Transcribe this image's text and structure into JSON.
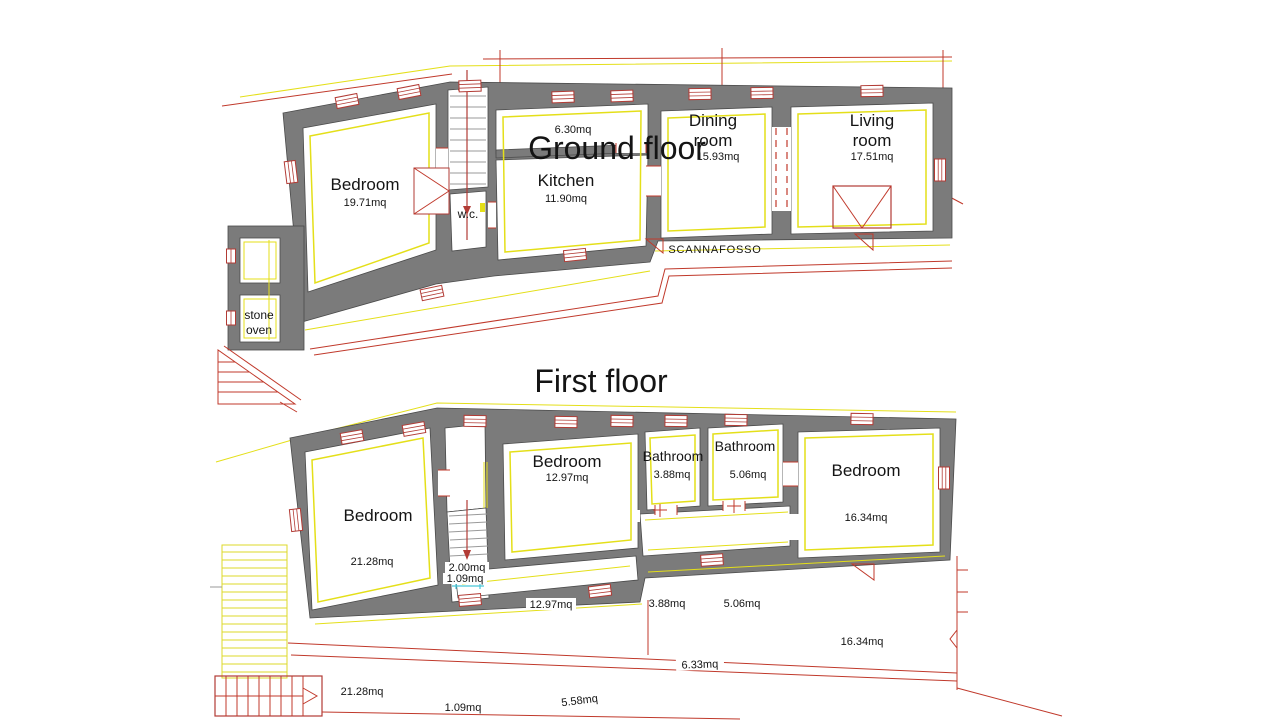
{
  "page": {
    "background": "#ffffff"
  },
  "titles": {
    "ground_floor": "Ground floor",
    "first_floor": "First floor"
  },
  "ground_floor": {
    "rooms": [
      {
        "name": "Bedroom",
        "area": "19.71mq"
      },
      {
        "name": "Kitchen",
        "area": "11.90mq"
      },
      {
        "name_line1": "Dining",
        "name_line2": "room",
        "area": "15.93mq"
      },
      {
        "name_line1": "Living",
        "name_line2": "room",
        "area": "17.51mq"
      },
      {
        "name": "w.c."
      },
      {
        "name_line1": "stone",
        "name_line2": "oven"
      }
    ],
    "labels": {
      "upper_room_area": "6.30mq",
      "trench": "SCANNAFOSSO"
    }
  },
  "first_floor": {
    "rooms": [
      {
        "name": "Bedroom",
        "area": "21.28mq"
      },
      {
        "name": "Bedroom",
        "area": "12.97mq"
      },
      {
        "name": "Bathroom",
        "area": "3.88mq"
      },
      {
        "name": "Bathroom",
        "area": "5.06mq"
      },
      {
        "name": "Bedroom",
        "area": "16.34mq"
      }
    ],
    "stair_labels": [
      "2.00mq",
      "1.09mq"
    ],
    "dimension_labels": [
      "12.97mq",
      "3.88mq",
      "5.06mq",
      "16.34mq",
      "6.33mq",
      "21.28mq",
      "1.09mq",
      "5.58mq"
    ]
  },
  "colors": {
    "wall_gray": "#7b7b7b",
    "guide_yellow": "#e4df19",
    "line_red": "#b23b35",
    "mark_cyan": "#49c6d8",
    "text": "#141414"
  }
}
